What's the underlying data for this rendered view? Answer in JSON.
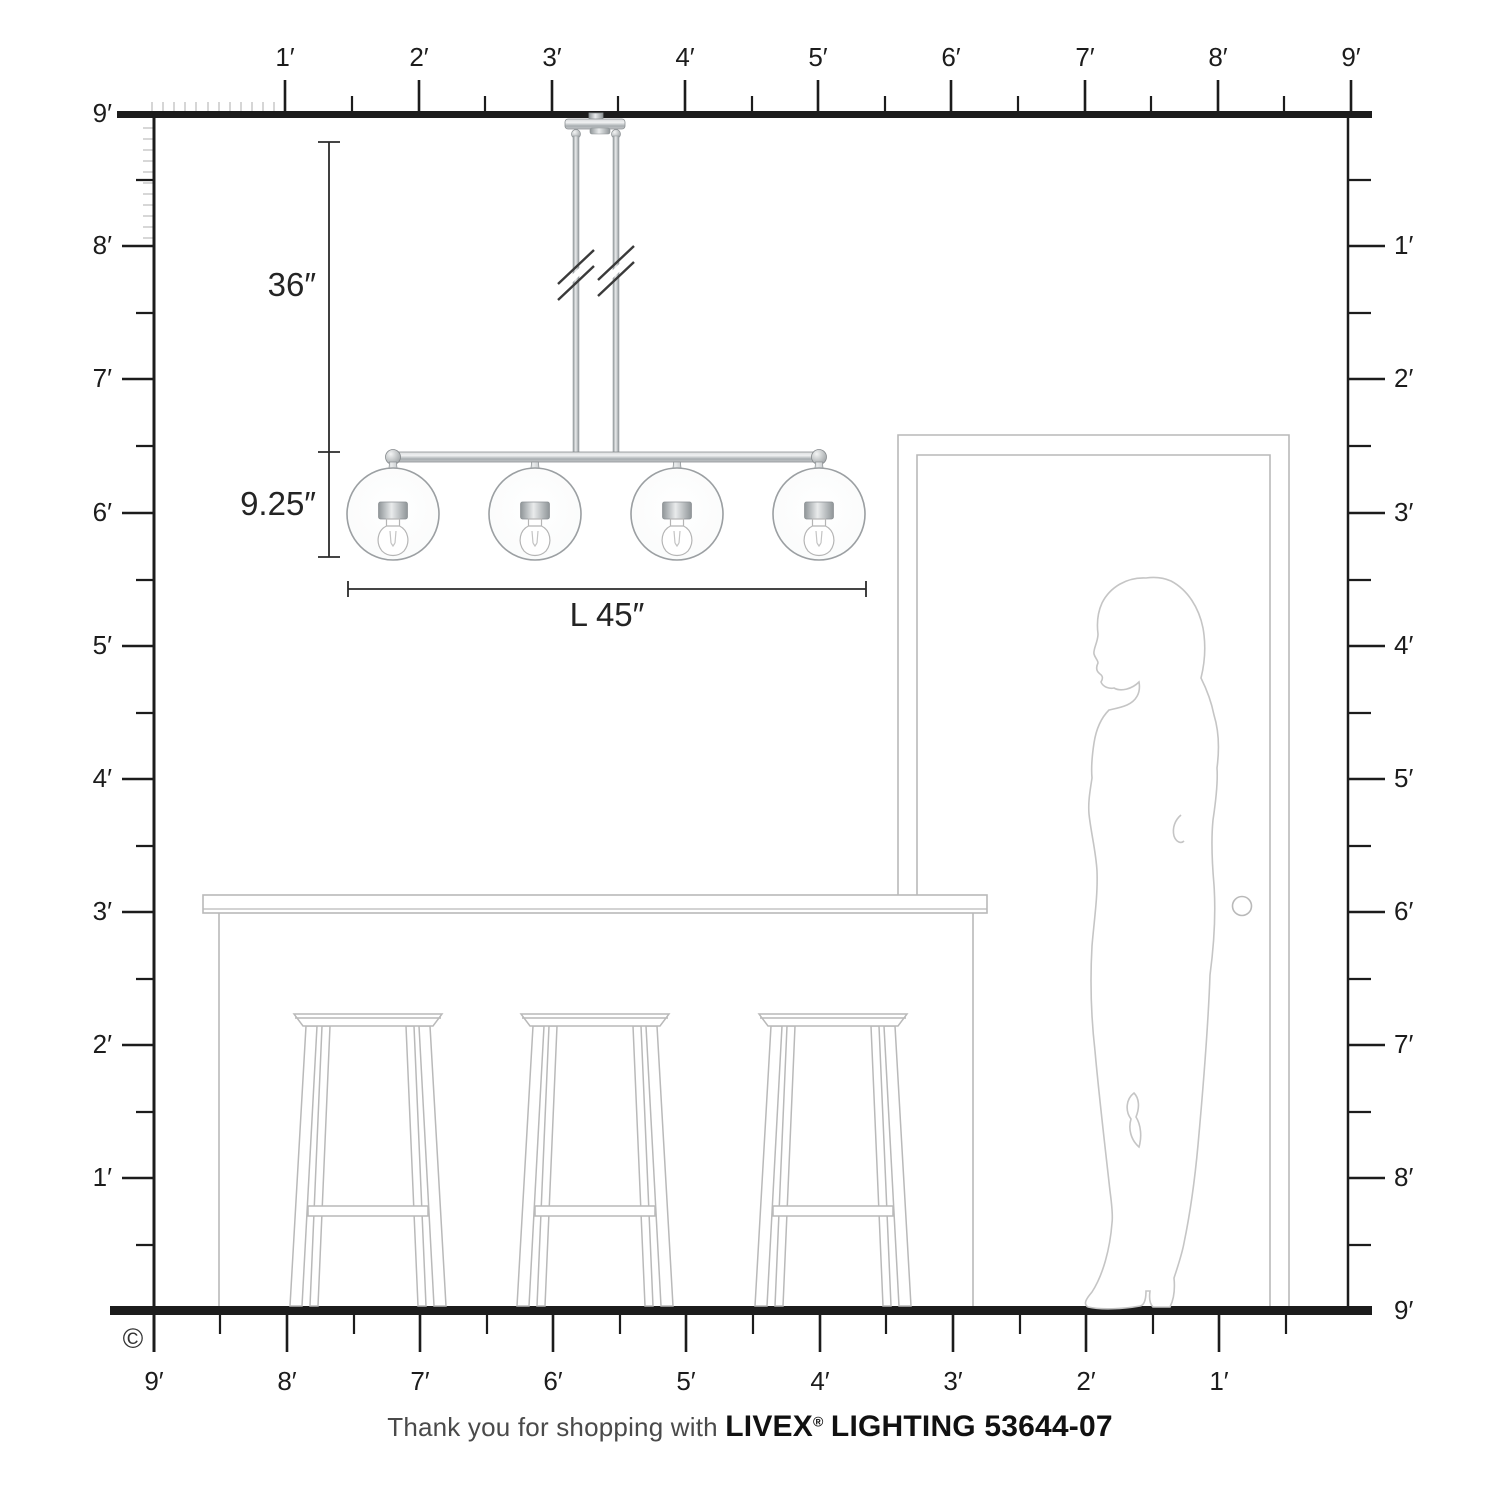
{
  "rulers": {
    "top": [
      "1′",
      "2′",
      "3′",
      "4′",
      "5′",
      "6′",
      "7′",
      "8′",
      "9′"
    ],
    "left": [
      "9′",
      "8′",
      "7′",
      "6′",
      "5′",
      "4′",
      "3′",
      "2′",
      "1′"
    ],
    "right": [
      "1′",
      "2′",
      "3′",
      "4′",
      "5′",
      "6′",
      "7′",
      "8′",
      "9′"
    ],
    "bottom": [
      "9′",
      "8′",
      "7′",
      "6′",
      "5′",
      "4′",
      "3′",
      "2′",
      "1′"
    ]
  },
  "dimensions": {
    "rod_drop": "36″",
    "fixture_height": "9.25″",
    "fixture_length": "L 45″"
  },
  "footer": {
    "prefix": "Thank you for shopping with",
    "brand": "LIVEX",
    "registered": "®",
    "product": "LIGHTING 53644-07"
  },
  "copyright": "©",
  "colors": {
    "structure_line": "#1c1c1c",
    "furniture_line": "#b9b9b9",
    "silhouette_line": "#c5c5c5",
    "fixture_silver": "#9aa0a4"
  }
}
